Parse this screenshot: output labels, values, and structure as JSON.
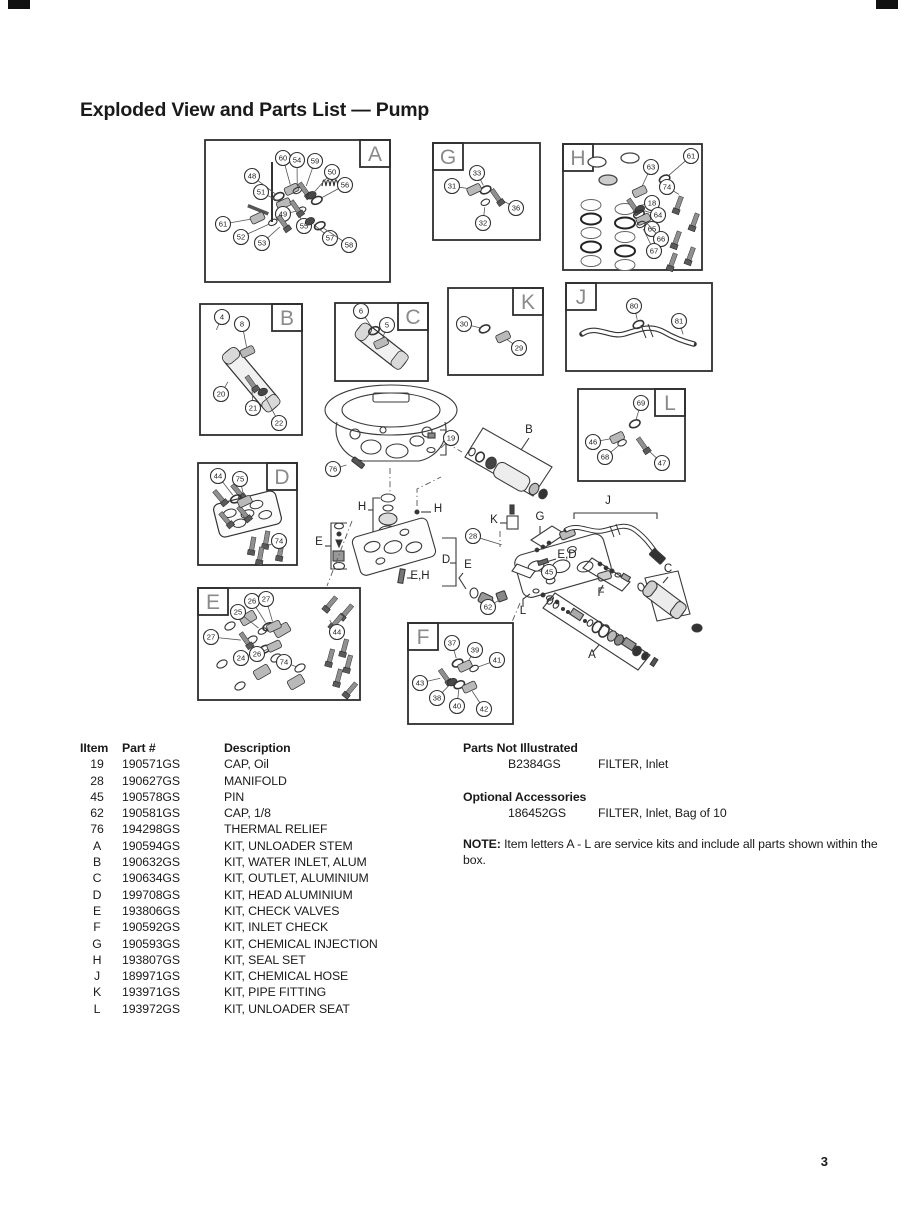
{
  "page": {
    "title": "Exploded View and Parts List — Pump",
    "page_number": "3"
  },
  "parts_table": {
    "headers": {
      "item": "IItem",
      "part": "Part #",
      "description": "Description"
    },
    "rows": [
      {
        "item": "19",
        "part": "190571GS",
        "description": "CAP, Oil"
      },
      {
        "item": "28",
        "part": "190627GS",
        "description": "MANIFOLD"
      },
      {
        "item": "45",
        "part": "190578GS",
        "description": "PIN"
      },
      {
        "item": "62",
        "part": "190581GS",
        "description": "CAP, 1/8"
      },
      {
        "item": "76",
        "part": "194298GS",
        "description": "THERMAL RELIEF"
      },
      {
        "item": "A",
        "part": "190594GS",
        "description": "KIT, UNLOADER STEM"
      },
      {
        "item": "B",
        "part": "190632GS",
        "description": "KIT, WATER INLET, ALUM"
      },
      {
        "item": "C",
        "part": "190634GS",
        "description": "KIT, OUTLET, ALUMINIUM"
      },
      {
        "item": "D",
        "part": "199708GS",
        "description": "KIT, HEAD ALUMINIUM"
      },
      {
        "item": "E",
        "part": "193806GS",
        "description": "KIT, CHECK VALVES"
      },
      {
        "item": "F",
        "part": "190592GS",
        "description": "KIT, INLET CHECK"
      },
      {
        "item": "G",
        "part": "190593GS",
        "description": "KIT, CHEMICAL INJECTION"
      },
      {
        "item": "H",
        "part": "193807GS",
        "description": "KIT, SEAL SET"
      },
      {
        "item": "J",
        "part": "189971GS",
        "description": "KIT, CHEMICAL HOSE"
      },
      {
        "item": "K",
        "part": "193971GS",
        "description": "KIT, PIPE FITTING"
      },
      {
        "item": "L",
        "part": "193972GS",
        "description": "KIT, UNLOADER SEAT"
      }
    ]
  },
  "not_illustrated": {
    "heading": "Parts Not Illustrated",
    "rows": [
      {
        "part": "B2384GS",
        "description": "FILTER, Inlet"
      }
    ]
  },
  "optional_accessories": {
    "heading": "Optional Accessories",
    "rows": [
      {
        "part": "186452GS",
        "description": "FILTER, Inlet, Bag of 10"
      }
    ]
  },
  "note": {
    "label": "NOTE:",
    "text": "Item letters A - L are service kits and include all parts shown within the box."
  },
  "diagram": {
    "kit_boxes": [
      {
        "label": "A",
        "x": 205,
        "y": 140,
        "w": 185,
        "h": 142,
        "corner": "tr",
        "feature": "stem",
        "callouts": [
          [
            48,
            252,
            176
          ],
          [
            60,
            283,
            158
          ],
          [
            54,
            297,
            160
          ],
          [
            59,
            315,
            161
          ],
          [
            50,
            332,
            172
          ],
          [
            56,
            345,
            185
          ],
          [
            51,
            261,
            192
          ],
          [
            49,
            283,
            214
          ],
          [
            55,
            304,
            226
          ],
          [
            57,
            330,
            238
          ],
          [
            58,
            349,
            245
          ],
          [
            61,
            223,
            224
          ],
          [
            52,
            241,
            237
          ],
          [
            53,
            262,
            243
          ]
        ]
      },
      {
        "label": "G",
        "x": 433,
        "y": 143,
        "w": 107,
        "h": 97,
        "corner": "tl",
        "callouts": [
          [
            33,
            477,
            173
          ],
          [
            31,
            452,
            186
          ],
          [
            32,
            483,
            223
          ],
          [
            36,
            516,
            208
          ]
        ]
      },
      {
        "label": "H",
        "x": 563,
        "y": 144,
        "w": 139,
        "h": 126,
        "corner": "tl",
        "feature": "seal-grid",
        "callouts": [
          [
            61,
            691,
            156
          ],
          [
            63,
            651,
            167
          ],
          [
            74,
            667,
            187,
            688,
            200
          ],
          [
            18,
            652,
            203
          ],
          [
            64,
            658,
            215
          ],
          [
            65,
            652,
            229
          ],
          [
            66,
            661,
            239
          ],
          [
            67,
            654,
            251
          ]
        ]
      },
      {
        "label": "B",
        "x": 200,
        "y": 304,
        "w": 102,
        "h": 131,
        "corner": "tr",
        "feature": "tube",
        "f_rot": 50,
        "f_len": 74,
        "f_dy": 10,
        "callouts": [
          [
            4,
            222,
            317,
            212,
            340
          ],
          [
            8,
            242,
            324
          ],
          [
            20,
            221,
            394,
            233,
            373
          ],
          [
            21,
            253,
            408
          ],
          [
            22,
            279,
            423
          ]
        ]
      },
      {
        "label": "C",
        "x": 335,
        "y": 303,
        "w": 93,
        "h": 78,
        "corner": "tr",
        "feature": "tube",
        "f_rot": 38,
        "f_len": 58,
        "f_dy": 4,
        "callouts": [
          [
            6,
            361,
            311
          ],
          [
            5,
            387,
            325
          ]
        ]
      },
      {
        "label": "K",
        "x": 448,
        "y": 288,
        "w": 95,
        "h": 87,
        "corner": "tr",
        "callouts": [
          [
            30,
            464,
            324
          ],
          [
            29,
            519,
            348
          ]
        ]
      },
      {
        "label": "J",
        "x": 566,
        "y": 283,
        "w": 146,
        "h": 88,
        "corner": "tl",
        "feature": "hose",
        "callouts": [
          [
            80,
            634,
            306
          ],
          [
            81,
            679,
            321,
            687,
            347
          ]
        ]
      },
      {
        "label": "L",
        "x": 578,
        "y": 389,
        "w": 107,
        "h": 92,
        "corner": "tr",
        "callouts": [
          [
            69,
            641,
            403
          ],
          [
            46,
            593,
            442
          ],
          [
            68,
            605,
            457
          ],
          [
            47,
            662,
            463
          ]
        ]
      },
      {
        "label": "D",
        "x": 198,
        "y": 463,
        "w": 99,
        "h": 102,
        "corner": "tr",
        "feature": "head",
        "callouts": [
          [
            44,
            218,
            476
          ],
          [
            75,
            240,
            479
          ],
          [
            74,
            279,
            541,
            262,
            548
          ]
        ]
      },
      {
        "label": "E",
        "x": 198,
        "y": 588,
        "w": 162,
        "h": 112,
        "corner": "tl",
        "feature": "hw-grid",
        "callouts": [
          [
            26,
            252,
            601
          ],
          [
            27,
            266,
            599
          ],
          [
            25,
            238,
            612
          ],
          [
            27,
            211,
            637
          ],
          [
            44,
            337,
            632,
            326,
            614
          ],
          [
            24,
            241,
            658
          ],
          [
            26,
            257,
            654
          ],
          [
            74,
            284,
            662,
            310,
            672
          ]
        ]
      },
      {
        "label": "F",
        "x": 408,
        "y": 623,
        "w": 105,
        "h": 101,
        "corner": "tl",
        "callouts": [
          [
            37,
            452,
            643
          ],
          [
            39,
            475,
            650
          ],
          [
            41,
            497,
            660
          ],
          [
            43,
            420,
            683
          ],
          [
            38,
            437,
            698
          ],
          [
            40,
            457,
            706
          ],
          [
            42,
            484,
            709
          ]
        ]
      }
    ],
    "assembly_callouts": [
      [
        76,
        333,
        469,
        350,
        464
      ],
      [
        19,
        451,
        438,
        446,
        443
      ],
      [
        28,
        473,
        536,
        532,
        554
      ],
      [
        45,
        549,
        572,
        538,
        571
      ],
      [
        62,
        488,
        607,
        501,
        599
      ]
    ],
    "assembly_labels": [
      [
        "B",
        529,
        433
      ],
      [
        "H",
        362,
        510
      ],
      [
        "H",
        438,
        512
      ],
      [
        "E",
        319,
        545
      ],
      [
        "E",
        468,
        568
      ],
      [
        "D",
        446,
        563
      ],
      [
        "E,H",
        420,
        579
      ],
      [
        "K",
        494,
        523
      ],
      [
        "G",
        540,
        520
      ],
      [
        "E,D",
        567,
        558
      ],
      [
        "L",
        523,
        614
      ],
      [
        "F",
        601,
        596
      ],
      [
        "C",
        668,
        572
      ],
      [
        "A",
        592,
        658
      ],
      [
        "J",
        608,
        504
      ]
    ]
  }
}
